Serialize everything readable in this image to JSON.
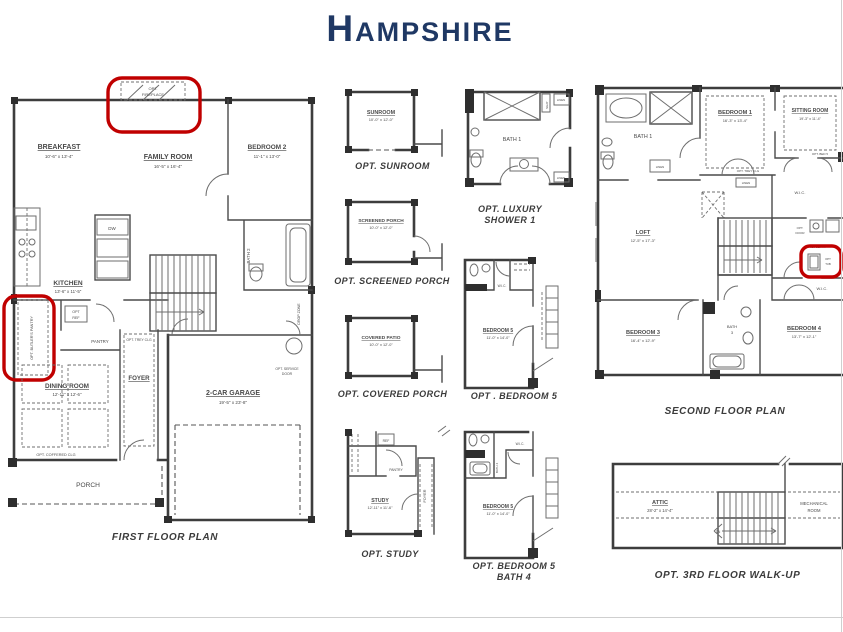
{
  "title": "HAMPSHIRE",
  "colors": {
    "navy": "#1F3864",
    "highlight_red": "#C00000",
    "line": "#3d3d3d"
  },
  "first_floor": {
    "caption": "FIRST FLOOR PLAN",
    "breakfast": {
      "name": "BREAKFAST",
      "dims": "10'-6\" x 13'-4\""
    },
    "family": {
      "name": "FAMILY ROOM",
      "dims": "16'-5\" x 16'-4\""
    },
    "bedroom2": {
      "name": "BEDROOM 2",
      "dims": "11'-1\" x 13'-0\""
    },
    "kitchen": {
      "name": "KITCHEN",
      "dims": "13'-6\" x 11'-5\""
    },
    "dining": {
      "name": "DINING ROOM",
      "dims": "12'-11\" x 12'-6\""
    },
    "foyer": "FOYER",
    "garage": {
      "name": "2-CAR GARAGE",
      "dims": "19'-5\" x 23'-8\""
    },
    "porch": "PORCH",
    "pantry": "PANTRY",
    "bath2": "BATH 2",
    "drop_zone": "DROP ZONE",
    "dw": "DW",
    "opt_fireplace_1": "OPT.",
    "opt_fireplace_2": "FIREPLACE",
    "opt_butlers_pantry": "OPT. BUTLER'S PANTRY",
    "opt_ref_1": "OPT",
    "opt_ref_2": "REF",
    "opt_trey": "OPT. TREY CLG",
    "opt_coffered": "OPT. COFFERED CLG",
    "opt_service_1": "OPT. SERVICE",
    "opt_service_2": "DOOR"
  },
  "options": {
    "sunroom": {
      "caption": "OPT. SUNROOM",
      "name": "SUNROOM",
      "dims": "10'-0\" x 12'-0\""
    },
    "screened_porch": {
      "caption": "OPT. SCREENED PORCH",
      "name": "SCREENED PORCH",
      "dims": "10'-0\" x 12'-0\""
    },
    "covered_porch": {
      "caption": "OPT. COVERED PORCH",
      "name": "COVERED PATIO",
      "dims": "10'-0\" x 12'-0\""
    },
    "study": {
      "caption": "OPT. STUDY",
      "name": "STUDY",
      "dims": "12'-11\" x 11'-6\"",
      "foyer": "FOYER",
      "ref": "REF",
      "pantry": "PANTRY"
    },
    "luxury_shower": {
      "caption_1": "OPT. LUXURY",
      "caption_2": "SHOWER 1",
      "name": "BATH 1",
      "seat": "SEAT",
      "linen": "LINEN"
    },
    "bedroom5": {
      "caption": "OPT . BEDROOM 5",
      "name": "BEDROOM 5",
      "dims": "11'-0\" x 14'-0\"",
      "wic": "W.I.C."
    },
    "bedroom5_bath4": {
      "caption_1": "OPT. BEDROOM 5",
      "caption_2": "BATH 4",
      "name": "BEDROOM 5",
      "dims": "11'-0\" x 14'-0\"",
      "wic": "W.I.C.",
      "bath": "BATH 4"
    }
  },
  "second_floor": {
    "caption": "SECOND FLOOR PLAN",
    "bath1": "BATH 1",
    "bedroom1": {
      "name": "BEDROOM 1",
      "dims": "16'-3\" x 13'-4\""
    },
    "sitting": {
      "name": "SITTING ROOM",
      "dims": "19'-3\" x 11'-4\""
    },
    "loft": {
      "name": "LOFT",
      "dims": "12'-5\" x 17'-3\""
    },
    "laundry": "LAUNDRY",
    "bedroom3": {
      "name": "BEDROOM 3",
      "dims": "16'-4\" x 12'-9\""
    },
    "bath3_1": "BATH",
    "bath3_2": "3",
    "bedroom4": {
      "name": "BEDROOM 4",
      "dims": "13'-7\" x 12'-1\""
    },
    "wic1": "W.I.C.",
    "wic2": "W.I.C.",
    "linen": "LINEN",
    "opt_trey": "OPT. TREY CLG",
    "opt_bed5": "OPT. BED 5",
    "opt_door_1": "OPT.",
    "opt_door_2": "DOOR",
    "opt_tub_1": "OPT",
    "opt_tub_2": "TUB"
  },
  "third_floor": {
    "caption": "OPT. 3RD FLOOR WALK-UP",
    "attic": {
      "name": "ATTIC",
      "dims": "28'-2\" x 14'-4\""
    },
    "mechanical_1": "MECHANICAL",
    "mechanical_2": "ROOM",
    "dn": "DN"
  }
}
